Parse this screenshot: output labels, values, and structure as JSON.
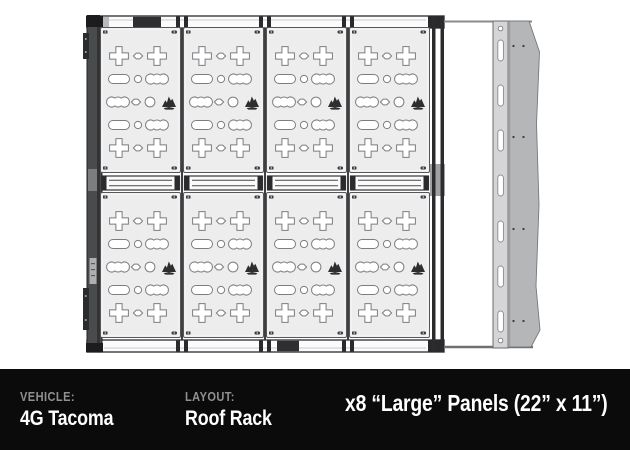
{
  "title": "Roof rack panel layout diagram",
  "footer": {
    "vehicle_label": "VEHICLE:",
    "vehicle_value": "4G Tacoma",
    "layout_label": "LAYOUT:",
    "layout_value": "Roof Rack",
    "headline": "x8 “Large” Panels (22” x 11”)",
    "bg": "#0b0b0b",
    "label_color": "#8e9092",
    "value_color": "#ffffff"
  },
  "diagram": {
    "grid": {
      "rows": 2,
      "cols": 4
    },
    "panel_count": 8,
    "colors": {
      "panel_fill": "#ededee",
      "panel_stroke": "#56575a",
      "cutout_stroke": "#7c7d80",
      "cutout_fill": "#ffffff",
      "rail_dark": "#3e3f41",
      "rail_darker": "#1c1c1e",
      "rail_fill": "#4a4b4d",
      "rail_white": "#fbfbfc",
      "clip_dark": "#2a2a2c",
      "strip_fill": "#d5d5d7",
      "strip_stroke": "#6b6c6e",
      "fairing_fill": "#b5b6b8",
      "fairing_stroke": "#78797b",
      "logo_fill": "#2e2e30",
      "screw_fill": "#3c3c3e",
      "hardware_dot": "#3e3e40"
    },
    "panel_pattern": [
      {
        "y": 29,
        "items": [
          {
            "type": "plus-cutout",
            "x": 19
          },
          {
            "type": "diamond-cutout",
            "x": 38
          },
          {
            "type": "plus-cutout",
            "x": 57
          }
        ]
      },
      {
        "y": 52,
        "items": [
          {
            "type": "oval-cutout",
            "x": 19
          },
          {
            "type": "circle-cutout",
            "x": 38
          },
          {
            "type": "scallop-cutout",
            "x": 57
          }
        ]
      },
      {
        "y": 75,
        "items": [
          {
            "type": "scallop-cutout",
            "x": 18
          },
          {
            "type": "diamond-cutout",
            "x": 36
          },
          {
            "type": "knob-cutout",
            "x": 50
          },
          {
            "type": "mountain-logo",
            "x": 69
          }
        ]
      },
      {
        "y": 98,
        "items": [
          {
            "type": "oval-cutout",
            "x": 19
          },
          {
            "type": "circle-cutout",
            "x": 38
          },
          {
            "type": "scallop-cutout",
            "x": 57
          }
        ]
      },
      {
        "y": 121,
        "items": [
          {
            "type": "plus-cutout",
            "x": 19
          },
          {
            "type": "diamond-cutout",
            "x": 38
          },
          {
            "type": "plus-cutout",
            "x": 57
          }
        ]
      }
    ],
    "slot_count": 7,
    "rivet_pair_count": 4
  }
}
